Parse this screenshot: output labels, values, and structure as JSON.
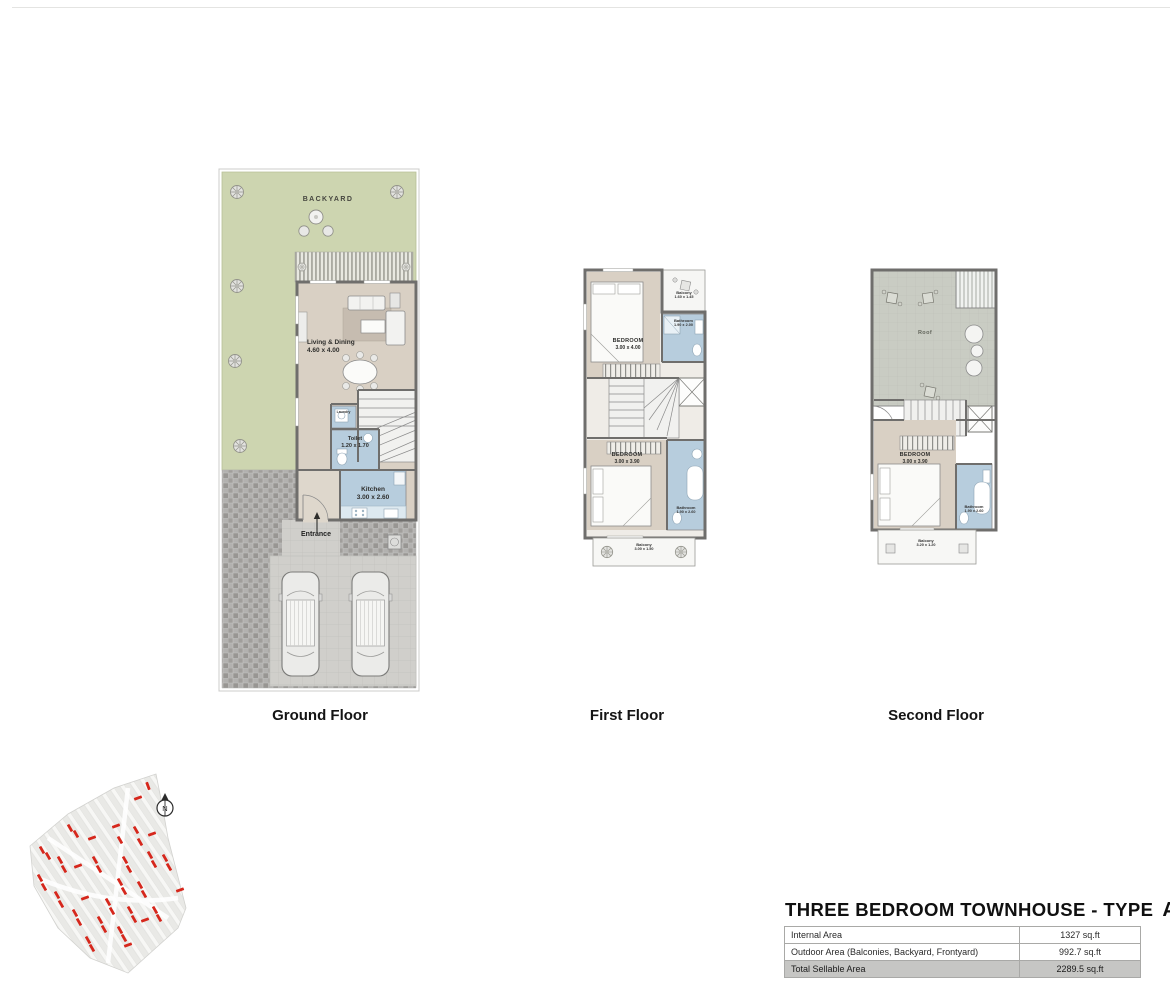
{
  "document": {
    "title_main": "THREE BEDROOM TOWNHOUSE - TYPE",
    "type_letter": "A"
  },
  "floor_plans": {
    "ground": {
      "caption": "Ground Floor",
      "backyard_label": "BACKYARD",
      "living_label": "Living & Dining",
      "living_dims": "4.60 x 4.00",
      "laundry_label": "Laundry",
      "toilet_label": "Toilet",
      "toilet_dims": "1.20 x 1.70",
      "kitchen_label": "Kitchen",
      "kitchen_dims": "3.00 x 2.60",
      "entrance_label": "Entrance"
    },
    "first": {
      "caption": "First Floor",
      "bedroom_top_label": "BEDROOM",
      "bedroom_top_dims": "3.00 x 4.00",
      "balcony_top_label": "Balcony",
      "balcony_top_dims": "1.60 x 1.45",
      "bathroom_top_label": "Bathroom",
      "bathroom_top_dims": "1.90 x 2.00",
      "bedroom_bottom_label": "BEDROOM",
      "bedroom_bottom_dims": "3.00 x 3.90",
      "bathroom_bottom_label": "Bathroom",
      "bathroom_bottom_dims": "1.90 x 2.60",
      "balcony_bottom_label": "Balcony",
      "balcony_bottom_dims": "3.00 x 1.50"
    },
    "second": {
      "caption": "Second Floor",
      "roof_label": "Roof",
      "bedroom_label": "BEDROOM",
      "bedroom_dims": "3.00 x 3.90",
      "bathroom_label": "Bathroom",
      "bathroom_dims": "1.90 x 2.60",
      "balcony_label": "Balcony",
      "balcony_dims": "3.20 x 1.20"
    }
  },
  "site_plan": {
    "north_label": "N"
  },
  "area_table": {
    "rows": [
      {
        "label": "Internal Area",
        "value": "1327 sq.ft"
      },
      {
        "label": "Outdoor Area (Balconies, Backyard, Frontyard)",
        "value": "992.7 sq.ft"
      },
      {
        "label": "Total Sellable Area",
        "value": "2289.5 sq.ft"
      }
    ]
  },
  "colors": {
    "backyard_green": "#cdd5b0",
    "room_tan": "#d9d0c4",
    "wet_blue": "#b7cddd",
    "wall_gray": "#6f6e6c",
    "roof_gray": "#c9ccc3",
    "site_red": "#d6271c",
    "table_highlight": "#c6c6c4"
  }
}
